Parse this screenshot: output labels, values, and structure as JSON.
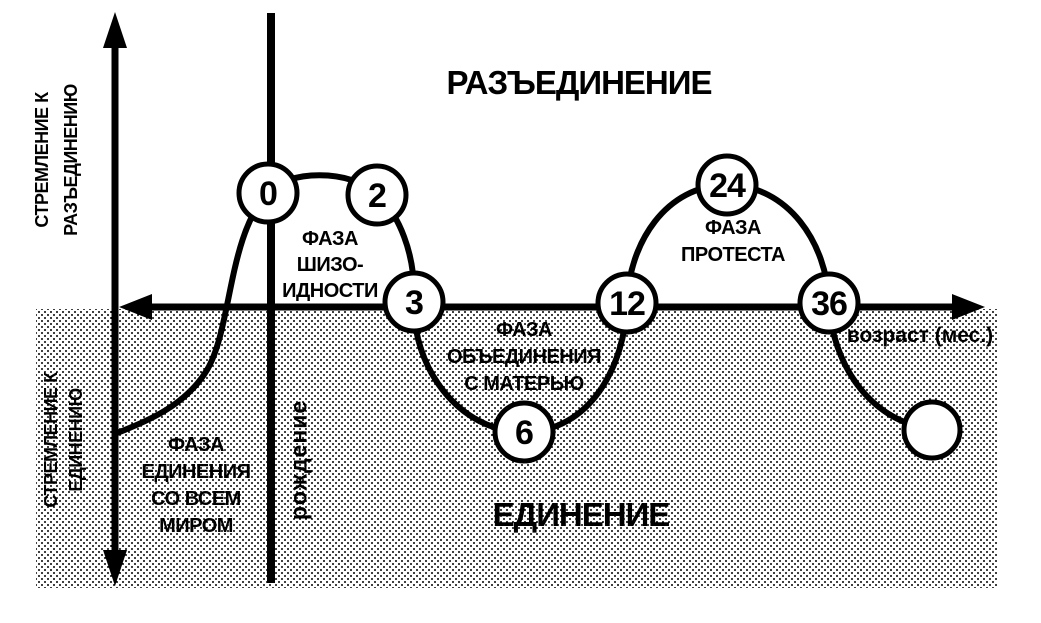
{
  "colors": {
    "ink": "#000000",
    "background": "#ffffff"
  },
  "titles": {
    "disunity": "РАЗЪЕДИНЕНИЕ",
    "unity": "ЕДИНЕНИЕ"
  },
  "y_axis": {
    "top_label": {
      "line1": "СТРЕМЛЕНИЕ К",
      "line2": "РАЗЪЕДИНЕНИЮ"
    },
    "bottom_label": {
      "line1": "СТРЕМЛЕНИЕ К",
      "line2": "ЕДИНЕНИЮ"
    }
  },
  "x_axis": {
    "label": "возраст (мес.)"
  },
  "birth_line": {
    "label": "рождение"
  },
  "phases": [
    {
      "id": "schizoid",
      "lines": [
        "ФАЗА",
        "ШИЗО-",
        "ИДНОСТИ"
      ]
    },
    {
      "id": "union-with-mother",
      "lines": [
        "ФАЗА",
        "ОБЪЕДИНЕНИЯ",
        "С МАТЕРЬЮ"
      ]
    },
    {
      "id": "protest",
      "lines": [
        "ФАЗА",
        "ПРОТЕСТА"
      ]
    },
    {
      "id": "unity-with-world",
      "lines": [
        "ФАЗА",
        "ЕДИНЕНИЯ",
        "СО ВСЕМ",
        "МИРОМ"
      ]
    }
  ],
  "milestones": {
    "unit": "months",
    "labeled": [
      "0",
      "2",
      "3",
      "6",
      "12",
      "24",
      "36"
    ],
    "unlabeled_final_circle": true
  }
}
